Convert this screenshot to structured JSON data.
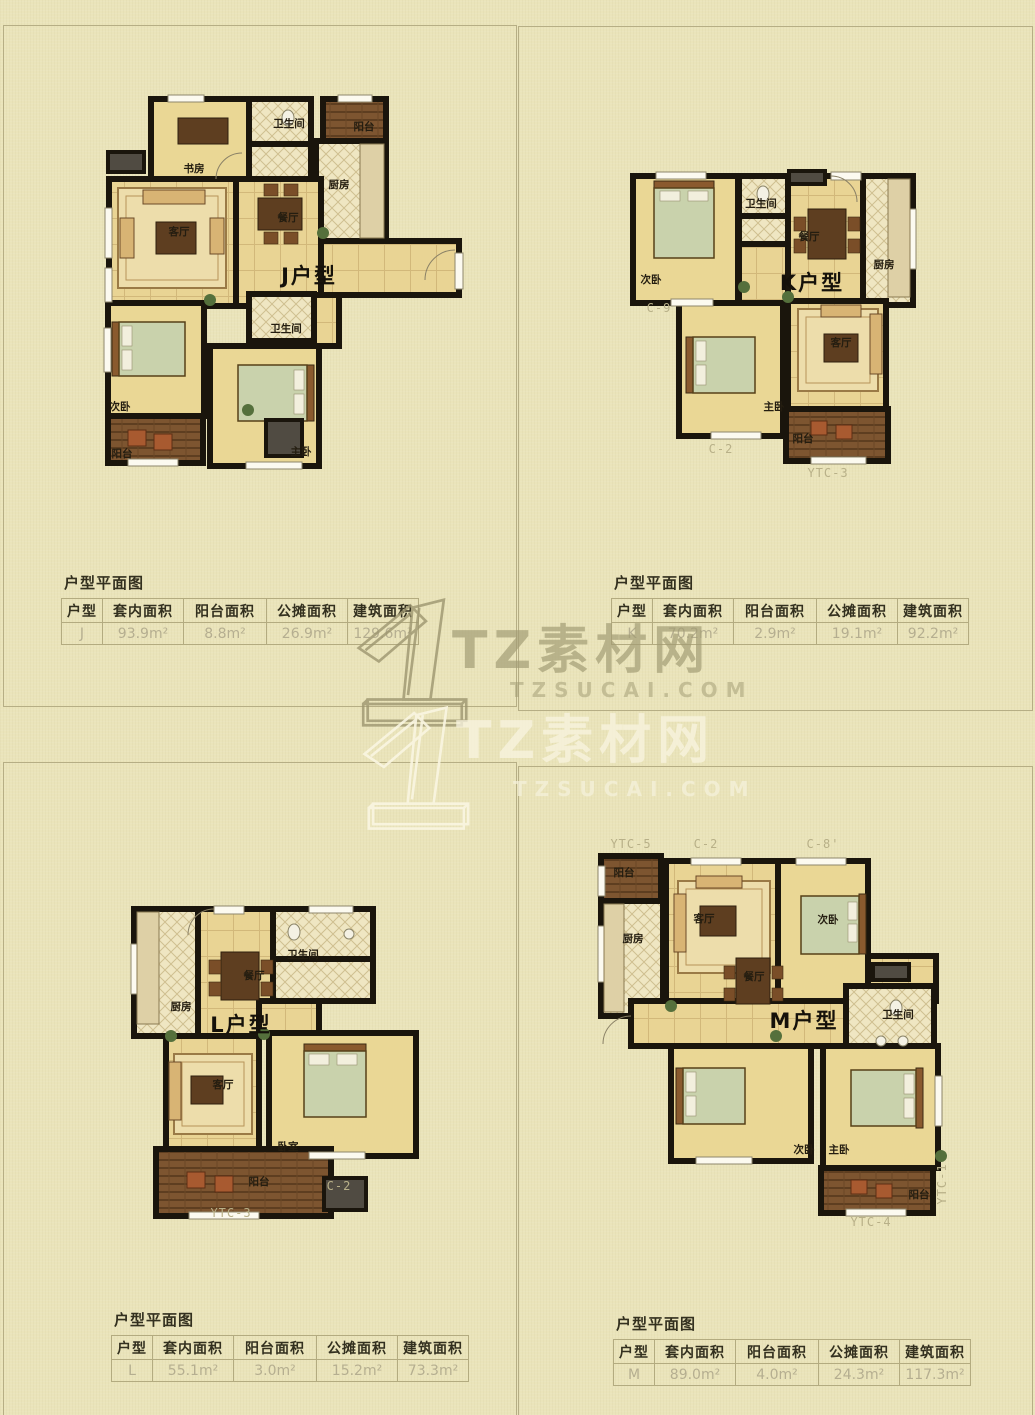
{
  "watermark": {
    "brand": "TZ素材网",
    "domain": "TZSUCAI.COM"
  },
  "panels": [
    {
      "plan_label": "J户型",
      "rooms": [
        "书房",
        "卫生间",
        "阳台",
        "厨房",
        "客厅",
        "餐厅",
        "卫生间",
        "次卧",
        "主卧",
        "阳台"
      ],
      "codes": [],
      "section_title": "户型平面图",
      "table": {
        "headers": [
          "户型",
          "套内面积",
          "阳台面积",
          "公摊面积",
          "建筑面积"
        ],
        "row": [
          "J",
          "93.9m²",
          "8.8m²",
          "26.9m²",
          "129.6m²"
        ]
      }
    },
    {
      "plan_label": "K户型",
      "rooms": [
        "次卧",
        "卫生间",
        "餐厅",
        "厨房",
        "主卧",
        "客厅",
        "阳台"
      ],
      "codes": [
        "C-9",
        "C-2",
        "YTC-3"
      ],
      "section_title": "户型平面图",
      "table": {
        "headers": [
          "户型",
          "套内面积",
          "阳台面积",
          "公摊面积",
          "建筑面积"
        ],
        "row": [
          "K",
          "70.2m²",
          "2.9m²",
          "19.1m²",
          "92.2m²"
        ]
      }
    },
    {
      "plan_label": "L户型",
      "rooms": [
        "厨房",
        "餐厅",
        "卫生间",
        "客厅",
        "卧室",
        "阳台"
      ],
      "codes": [
        "C-2",
        "YTC-3"
      ],
      "section_title": "户型平面图",
      "table": {
        "headers": [
          "户型",
          "套内面积",
          "阳台面积",
          "公摊面积",
          "建筑面积"
        ],
        "row": [
          "L",
          "55.1m²",
          "3.0m²",
          "15.2m²",
          "73.3m²"
        ]
      }
    },
    {
      "plan_label": "M户型",
      "rooms": [
        "阳台",
        "厨房",
        "客厅",
        "次卧",
        "餐厅",
        "卫生间",
        "次卧",
        "主卧",
        "阳台"
      ],
      "codes": [
        "YTC-5",
        "C-2",
        "C-8'",
        "YTC-1",
        "YTC-4"
      ],
      "section_title": "户型平面图",
      "table": {
        "headers": [
          "户型",
          "套内面积",
          "阳台面积",
          "公摊面积",
          "建筑面积"
        ],
        "row": [
          "M",
          "89.0m²",
          "4.0m²",
          "24.3m²",
          "117.3m²"
        ]
      }
    }
  ]
}
